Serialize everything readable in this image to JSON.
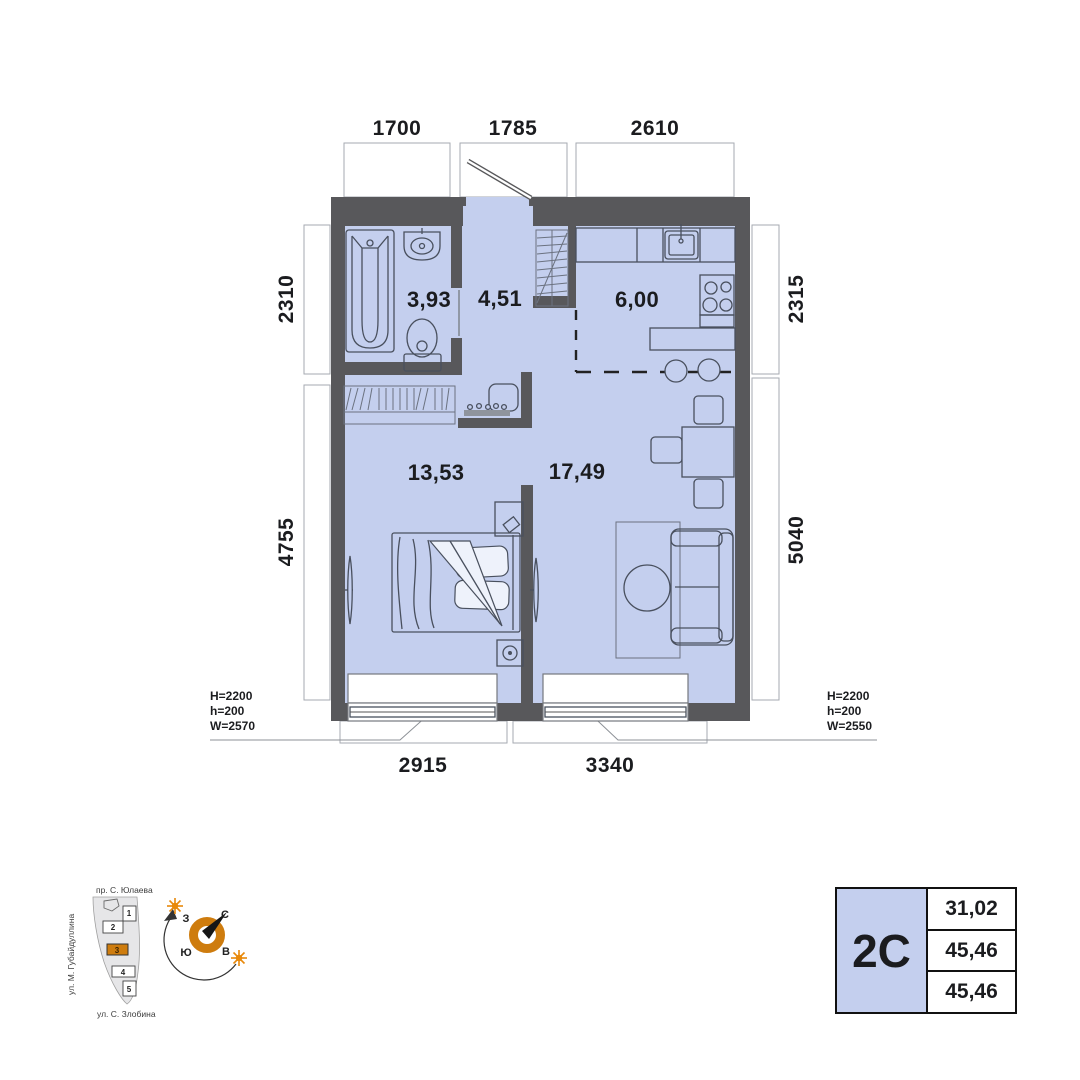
{
  "plan": {
    "dims_top": [
      "1700",
      "1785",
      "2610"
    ],
    "dims_left": [
      "2310",
      "4755"
    ],
    "dims_right": [
      "2315",
      "5040"
    ],
    "dims_bottom": [
      "2915",
      "3340"
    ],
    "rooms": {
      "bathroom": "3,93",
      "hallway": "4,51",
      "kitchen": "6,00",
      "bedroom": "13,53",
      "living": "17,49"
    },
    "window_note_left": {
      "H": "H=2200",
      "h": "h=200",
      "W": "W=2570"
    },
    "window_note_right": {
      "H": "H=2200",
      "h": "h=200",
      "W": "W=2550"
    }
  },
  "site_plan": {
    "street_top": "пр. С. Юлаева",
    "street_left": "ул. М. Губайдуллина",
    "street_bottom": "ул. С. Злобина",
    "buildings": [
      "1",
      "2",
      "3",
      "4",
      "5"
    ],
    "highlighted_building": "3"
  },
  "compass": {
    "west": "З",
    "north": "С",
    "south": "Ю",
    "east": "В"
  },
  "info_table": {
    "unit_label": "2С",
    "values": [
      "31,02",
      "45,46",
      "45,46"
    ]
  },
  "colors": {
    "floor": "#c4cfee",
    "wall": "#58585b",
    "accent": "#ce7c0e",
    "line": "#49505e",
    "ink": "#1b1c1f"
  }
}
